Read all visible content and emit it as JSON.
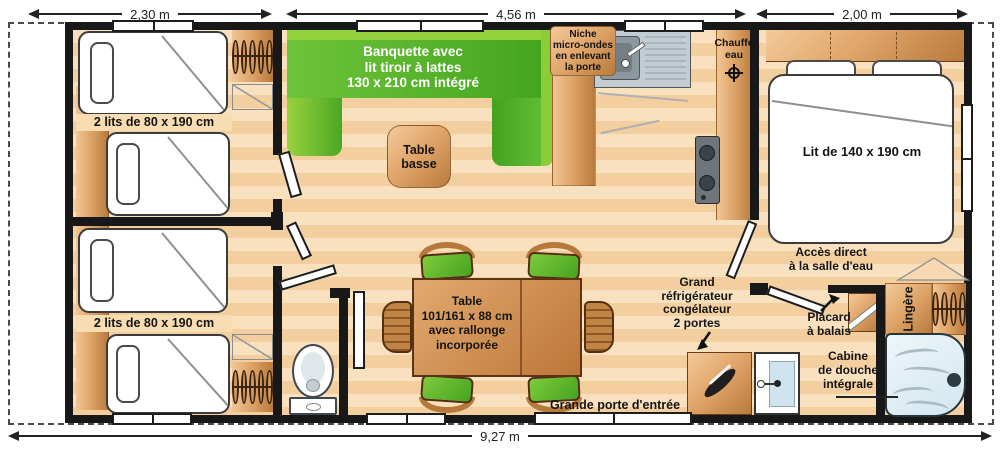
{
  "dimensions": {
    "top": [
      {
        "label": "2,30 m"
      },
      {
        "label": "4,56 m"
      },
      {
        "label": "2,00 m"
      }
    ],
    "bottom_label": "9,27 m"
  },
  "rooms": {
    "bedroom_top_label": "2 lits de 80 x 190 cm",
    "bedroom_bottom_label": "2 lits de 80 x 190 cm",
    "master_bedroom_label": "Lit de 140 x 190 cm"
  },
  "living": {
    "banquette_label": "Banquette avec\nlit tiroir à lattes\n130 x 210 cm intégré",
    "coffee_table_label": "Table\nbasse",
    "dining_table_label": "Table\n101/161 x 88 cm\navec rallonge\nincorporée",
    "entrance_label": "Grande porte d'entrée"
  },
  "kitchen": {
    "microwave_niche_label": "Niche\nmicro-ondes\nen enlevant\nla porte",
    "water_heater_label": "Chauffe\neau",
    "fridge_label": "Grand\nréfrigérateur\ncongélateur\n2 portes"
  },
  "bathroom": {
    "access_label": "Accès direct\nà la salle d'eau",
    "broom_closet_label": "Placard\nà balais",
    "linen_closet_label": "Lingère",
    "shower_label": "Cabine\nde douche\nintégrale"
  },
  "colors": {
    "wall": "#181818",
    "floor_light": "#f9e1bf",
    "floor_dark": "#f3cf9f",
    "bench_green": "#55b42a",
    "bench_green_light": "#93d13d",
    "wood_light": "#f4ca9b",
    "wood_dark": "#b97a3d",
    "shower_blue": "#dcebf3"
  }
}
